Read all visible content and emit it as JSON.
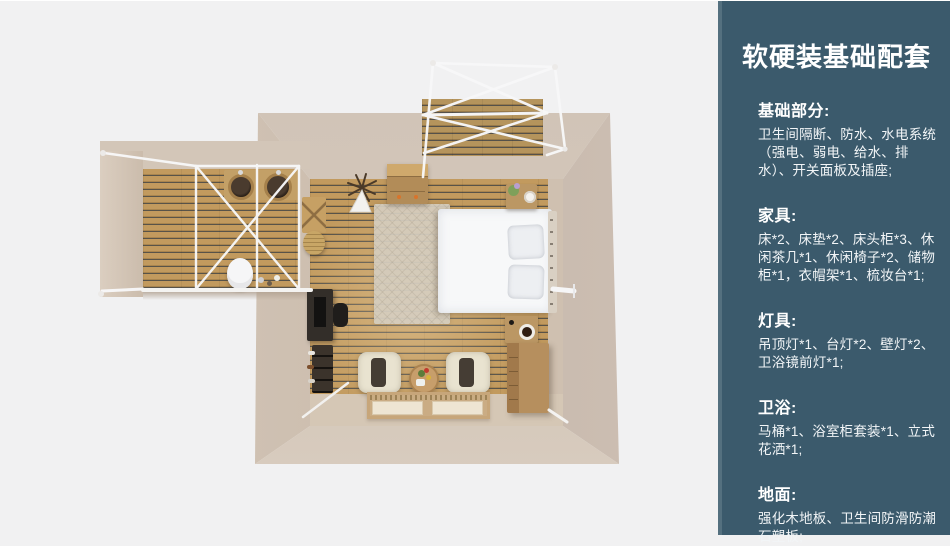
{
  "sidebar": {
    "title": "软硬装基础配套",
    "sections": [
      {
        "heading": "基础部分:",
        "body": "卫生间隔断、防水、水电系统（强电、弱电、给水、排水）、开关面板及插座;"
      },
      {
        "heading": "家具:",
        "body": "床*2、床垫*2、床头柜*3、休闲茶几*1、休闲椅子*2、储物柜*1，衣帽架*1、梳妆台*1;"
      },
      {
        "heading": "灯具:",
        "body": "吊顶灯*1、台灯*2、壁灯*2、卫浴镜前灯*1;"
      },
      {
        "heading": "卫浴:",
        "body": "马桶*1、浴室柜套装*1、立式花洒*1;"
      },
      {
        "heading": "地面:",
        "body": "强化木地板、卫生间防滑防潮石塑板;"
      }
    ]
  },
  "floorplan": {
    "view": "top-down-3d-render",
    "areas": [
      "bedroom",
      "bathroom-annex",
      "balcony"
    ],
    "furniture": [
      "canopy-frame",
      "double-sink-vanity",
      "toilet",
      "storage-cabinet",
      "hanging-ornament",
      "rug",
      "double-bed",
      "nightstand",
      "desk",
      "desk-chair",
      "shoe-rack",
      "lounge-chair",
      "round-tea-table",
      "floor-mats",
      "dresser",
      "wall-lamp",
      "coat-rack",
      "basket"
    ],
    "colors": {
      "background": "#f1f1f2",
      "sidebar_bg": "#3b5a6c",
      "sidebar_strip": "#54707f",
      "text": "#ffffff",
      "wall_beige": "#d3c6b8",
      "floor_plank": "#c29a5e",
      "plank_gap": "#585349",
      "furniture_wood": "#b28c58",
      "bed_white": "#f7f8f9"
    }
  }
}
